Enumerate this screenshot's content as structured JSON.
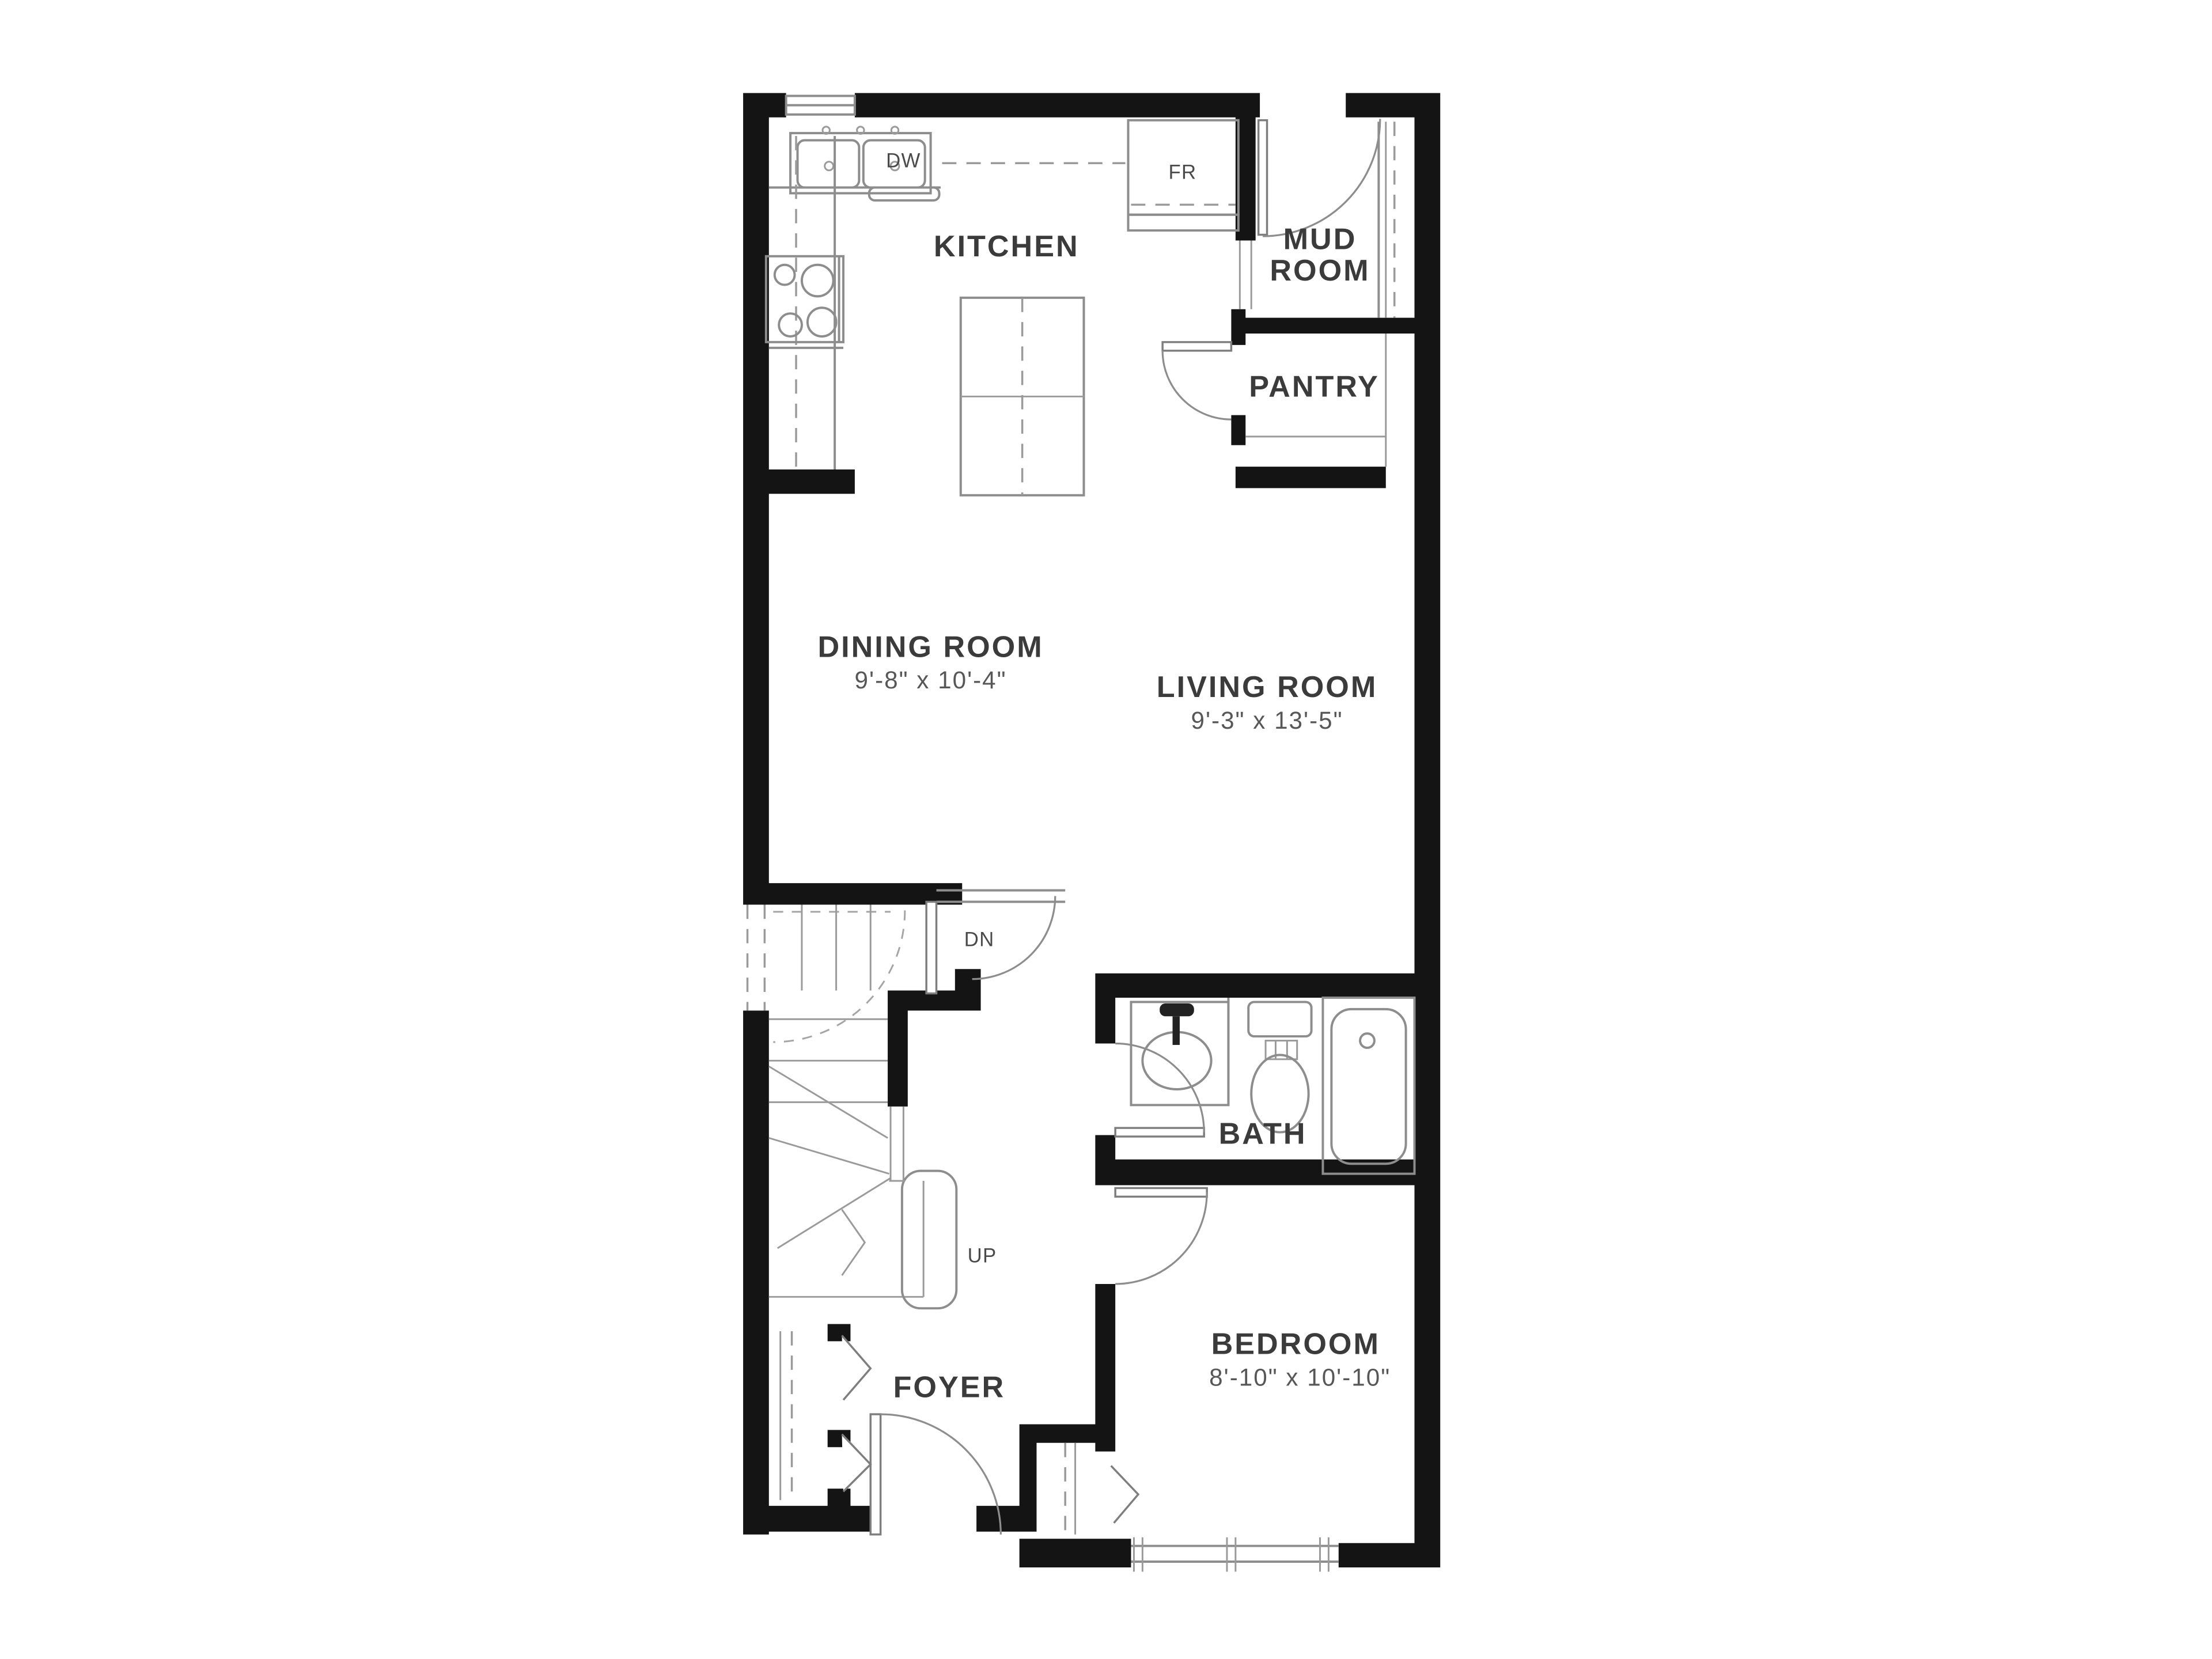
{
  "floor_plan": {
    "rooms": {
      "kitchen": {
        "label": "KITCHEN"
      },
      "mud_room": {
        "label_line1": "MUD",
        "label_line2": "ROOM"
      },
      "pantry": {
        "label": "PANTRY"
      },
      "dining_room": {
        "label": "DINING ROOM",
        "dimensions": "9'-8\" x 10'-4\""
      },
      "living_room": {
        "label": "LIVING ROOM",
        "dimensions": "9'-3\" x 13'-5\""
      },
      "bath": {
        "label": "BATH"
      },
      "bedroom": {
        "label": "BEDROOM",
        "dimensions": "8'-10\" x 10'-10\""
      },
      "foyer": {
        "label": "FOYER"
      }
    },
    "annotations": {
      "dishwasher": "DW",
      "fridge": "FR",
      "stairs_down": "DN",
      "stairs_up": "UP"
    },
    "colors": {
      "wall": "#141414",
      "fixture_line": "#8d8d8d",
      "dashed_line": "#9a9a9a",
      "label_text": "#3b3b3b",
      "dimension_text": "#575757",
      "background": "#ffffff"
    }
  }
}
